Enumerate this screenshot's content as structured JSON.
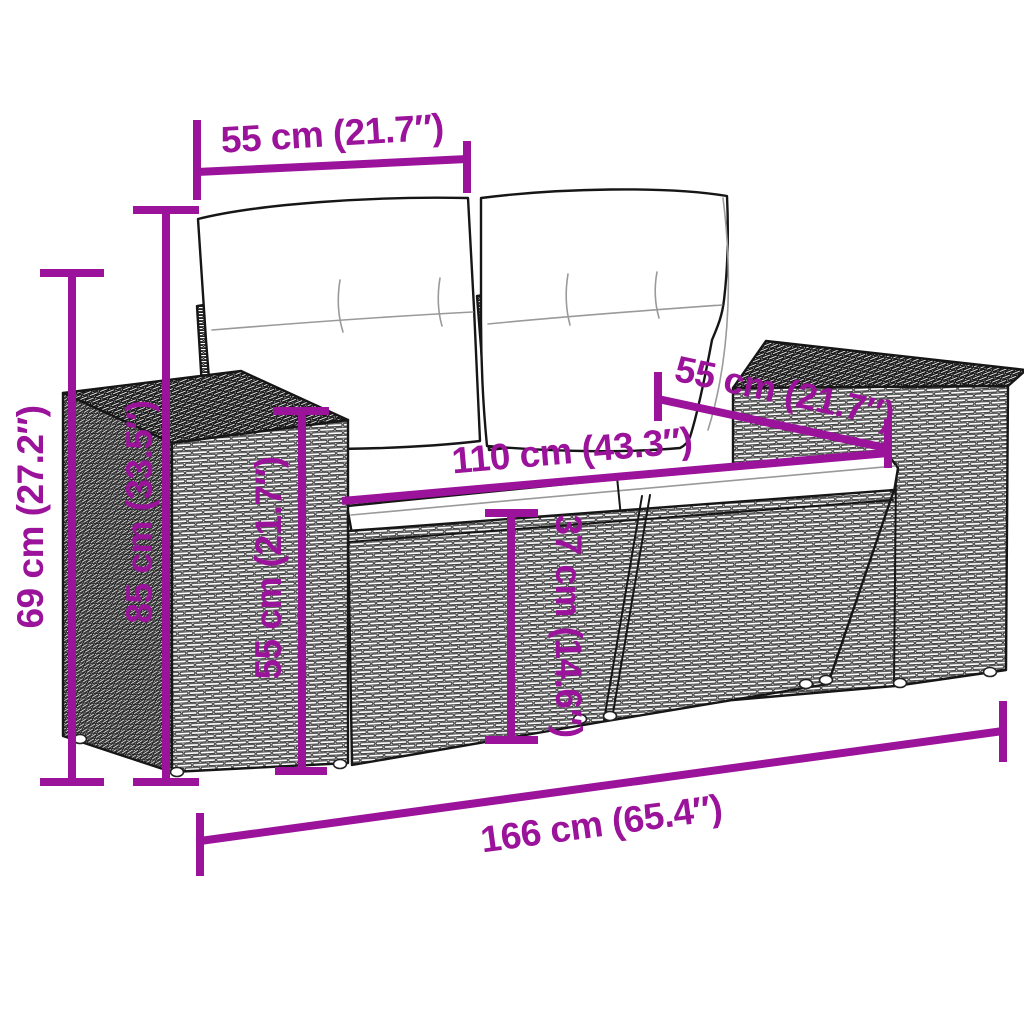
{
  "canvas": {
    "background": "#ffffff"
  },
  "style": {
    "accent_color": "#9B129B",
    "outline_color": "#161616"
  },
  "measurements": {
    "back_cushion_width": {
      "label": "55 cm (21.7″)",
      "value_cm": 55,
      "value_in": 21.7
    },
    "total_height": {
      "label": "69 cm (27.2″)",
      "value_cm": 69,
      "value_in": 27.2
    },
    "back_height": {
      "label": "85 cm (33.5″)",
      "value_cm": 85,
      "value_in": 33.5
    },
    "armrest_height": {
      "label": "55 cm (21.7″)",
      "value_cm": 55,
      "value_in": 21.7
    },
    "seat_height": {
      "label": "37 cm (14.6″)",
      "value_cm": 37,
      "value_in": 14.6
    },
    "seat_width": {
      "label": "110 cm (43.3″)",
      "value_cm": 110,
      "value_in": 43.3
    },
    "seat_depth": {
      "label": "55 cm (21.7″)",
      "value_cm": 55,
      "value_in": 21.7
    },
    "total_width": {
      "label": "166 cm (65.4″)",
      "value_cm": 166,
      "value_in": 65.4
    }
  }
}
